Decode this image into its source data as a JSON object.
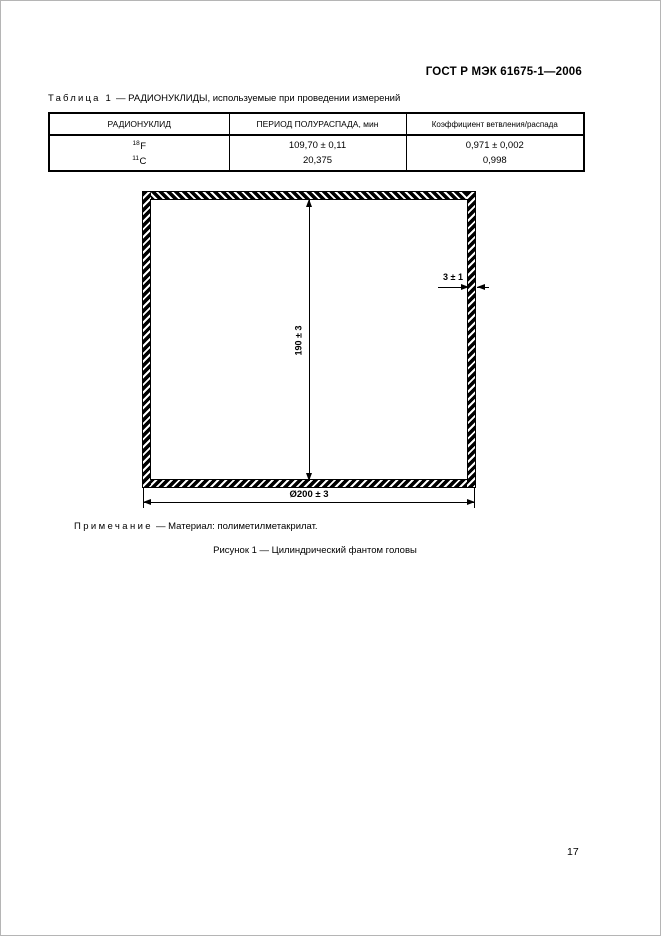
{
  "document": {
    "standard_code": "ГОСТ Р МЭК 61675-1—2006",
    "page_number": "17"
  },
  "table": {
    "label": "Таблица 1",
    "title": "— РАДИОНУКЛИДЫ, используемые при проведении измерений",
    "columns": [
      "РАДИОНУКЛИД",
      "ПЕРИОД ПОЛУРАСПАДА, мин",
      "Коэффициент ветвления/распада"
    ],
    "rows": [
      {
        "mass": "18",
        "symbol": "F",
        "half_life": "109,70 ± 0,11",
        "branching": "0,971 ± 0,002"
      },
      {
        "mass": "11",
        "symbol": "C",
        "half_life": "20,375",
        "branching": "0,998"
      }
    ]
  },
  "figure": {
    "height_dimension": "190 ± 3",
    "wall_dimension": "3 ± 1",
    "diameter_dimension": "Ø200 ± 3",
    "note_label": "Примечание",
    "note_text": "— Материал: полиметилметакрилат.",
    "caption": "Рисунок 1 — Цилиндрический фантом головы"
  }
}
